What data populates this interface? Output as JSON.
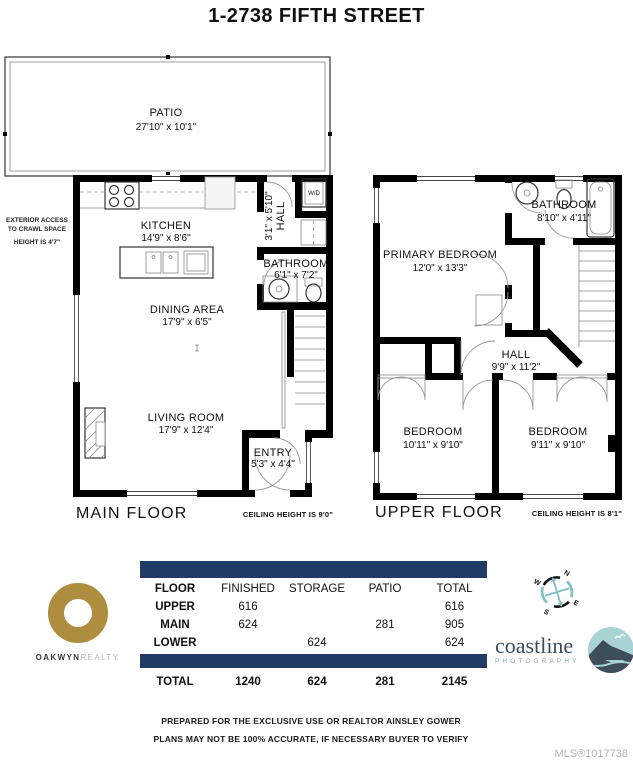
{
  "title": "1-2738 FIFTH STREET",
  "main_floor": {
    "patio_name": "PATIO",
    "patio_dims": "27'10\" x 10'1\"",
    "kitchen_name": "KITCHEN",
    "kitchen_dims": "14'9\" x 8'6\"",
    "hall_name": "HALL",
    "hall_dims": "3'1\" x 5'10\"",
    "wd_label": "W/D",
    "bathroom_name": "BATHROOM",
    "bathroom_dims": "6'1\" x 7'2\"",
    "dining_name": "DINING AREA",
    "dining_dims": "17'9\" x 6'5\"",
    "living_name": "LIVING ROOM",
    "living_dims": "17'9\" x 12'4\"",
    "entry_name": "ENTRY",
    "entry_dims": "5'3\" x 4'4\"",
    "floor_label": "MAIN FLOOR",
    "ceiling_note": "CEILING HEIGHT IS 9'0\"",
    "exterior_note_1": "EXTERIOR ACCESS",
    "exterior_note_2": "TO CRAWL SPACE",
    "exterior_note_3": "HEIGHT IS 4'7\""
  },
  "upper_floor": {
    "primary_name": "PRIMARY BEDROOM",
    "primary_dims": "12'0\" x 13'3\"",
    "bathroom_name": "BATHROOM",
    "bathroom_dims": "8'10\" x 4'11\"",
    "hall_name": "HALL",
    "hall_dims": "9'9\" x 11'2\"",
    "bedroom_left_name": "BEDROOM",
    "bedroom_left_dims": "10'11\" x 9'10\"",
    "bedroom_right_name": "BEDROOM",
    "bedroom_right_dims": "9'11\" x 9'10\"",
    "floor_label": "UPPER FLOOR",
    "ceiling_note": "CEILING HEIGHT IS 8'1\""
  },
  "area_table": {
    "columns": [
      "FLOOR",
      "FINISHED",
      "STORAGE",
      "PATIO",
      "TOTAL"
    ],
    "rows": [
      {
        "floor": "UPPER",
        "finished": "616",
        "storage": "",
        "patio": "",
        "total": "616"
      },
      {
        "floor": "MAIN",
        "finished": "624",
        "storage": "",
        "patio": "281",
        "total": "905"
      },
      {
        "floor": "LOWER",
        "finished": "",
        "storage": "624",
        "patio": "",
        "total": "624"
      }
    ],
    "total_row": {
      "floor": "TOTAL",
      "finished": "1240",
      "storage": "624",
      "patio": "281",
      "total": "2145"
    },
    "bar_color": "#1e3c64"
  },
  "logos": {
    "oakwyn": {
      "name_bold": "OAKWYN",
      "name_light": "REALTY",
      "ring_color": "#ae8d3f"
    },
    "coastline": {
      "name": "coastline",
      "subtitle": "PHOTOGRAPHY",
      "teal": "#a8d2d4",
      "slate": "#3d4e5a"
    }
  },
  "compass": {
    "n": "N",
    "e": "E",
    "s": "S",
    "w": "W"
  },
  "footer": {
    "line1": "PREPARED FOR THE EXCLUSIVE USE OR REALTOR AINSLEY GOWER",
    "line2": "PLANS MAY NOT BE 100% ACCURATE, IF NECESSARY BUYER TO VERIFY",
    "mls": "MLS®1017738"
  }
}
